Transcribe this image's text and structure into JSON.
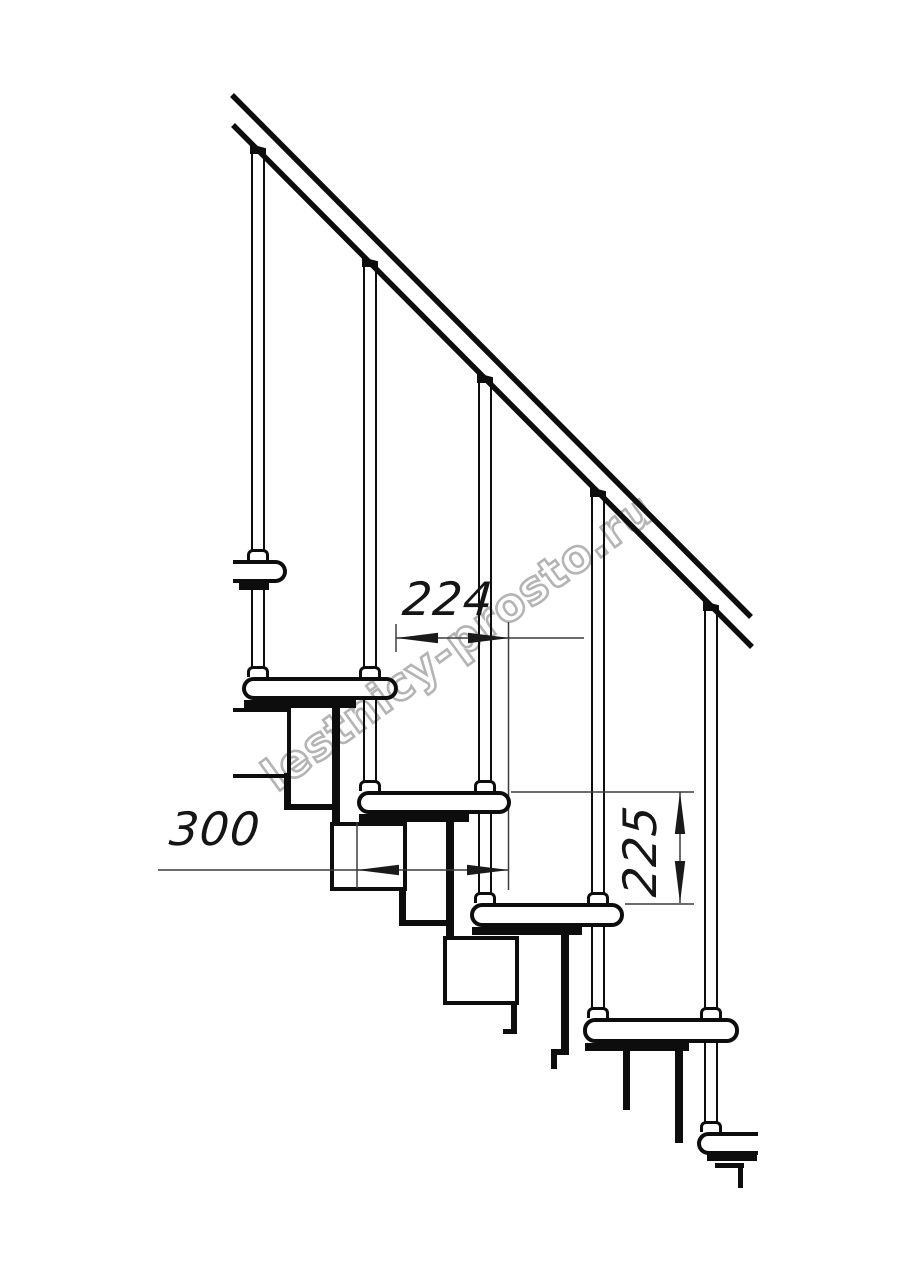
{
  "document": {
    "kind": "technical line drawing",
    "subject": "modular staircase side elevation with handrail",
    "background": "#ffffff",
    "line_color": "#0d0d0d",
    "dim_line_color": "#3c3c3c"
  },
  "watermark": {
    "text": "lestnicy-prosto.ru",
    "color": "#b4b4b4",
    "rotation_deg": -36
  },
  "dimensions": {
    "step_run": {
      "label": "224",
      "orientation": "horizontal"
    },
    "tread_depth": {
      "label": "300",
      "orientation": "horizontal"
    },
    "riser_height": {
      "label": "225",
      "orientation": "vertical"
    }
  },
  "structure": {
    "treads_visible": 6,
    "balusters_visible": 5,
    "stringer_modules_visible": 3,
    "handrail": "diagonal from upper-left down to mid-right"
  }
}
